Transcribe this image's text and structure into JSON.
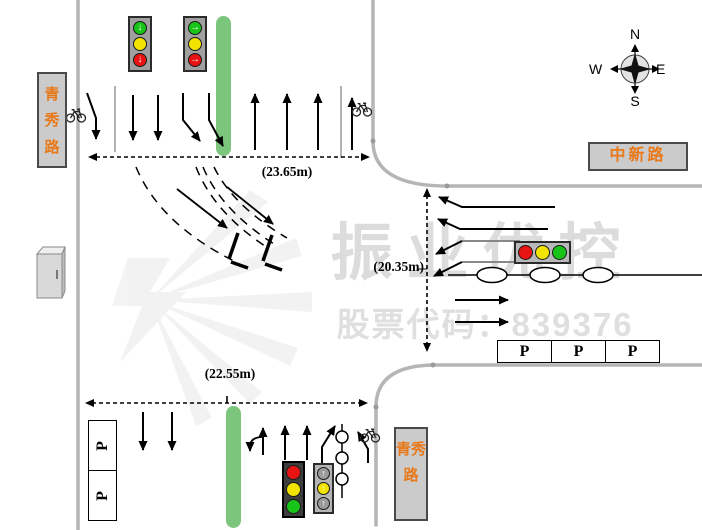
{
  "road_labels": {
    "north": "青秀路",
    "east": "中新路",
    "south": "青秀路"
  },
  "dimensions": {
    "north_width": "(23.65m)",
    "east_width": "(20.35m)",
    "south_width": "(22.55m)"
  },
  "compass": {
    "n": "N",
    "e": "E",
    "s": "S",
    "w": "W"
  },
  "parking": {
    "symbol": "P",
    "east_row_cells": 3,
    "south_column_cells": 2
  },
  "watermark": {
    "company": "振业优控",
    "stock_line": "股票代码：839376"
  },
  "traffic_lights": {
    "north_left": {
      "lamps": [
        {
          "color": "green",
          "glyph": "↓"
        },
        {
          "color": "yellow",
          "glyph": ""
        },
        {
          "color": "red",
          "glyph": "↓"
        }
      ]
    },
    "north_right": {
      "lamps": [
        {
          "color": "green",
          "glyph": "→"
        },
        {
          "color": "yellow",
          "glyph": ""
        },
        {
          "color": "red",
          "glyph": "→"
        }
      ]
    },
    "east": {
      "lamps": [
        {
          "color": "red",
          "glyph": ""
        },
        {
          "color": "yellow",
          "glyph": ""
        },
        {
          "color": "green",
          "glyph": ""
        }
      ]
    },
    "south_left": {
      "lamps": [
        {
          "color": "red",
          "glyph": ""
        },
        {
          "color": "yellow",
          "glyph": ""
        },
        {
          "color": "green",
          "glyph": ""
        }
      ]
    },
    "south_right": {
      "lamps": [
        {
          "color": "gray",
          "glyph": "↑"
        },
        {
          "color": "yellow",
          "glyph": "↑"
        },
        {
          "color": "gray",
          "glyph": "↑"
        }
      ]
    }
  },
  "colors": {
    "road_edge": "#B5B5B5",
    "median_green": "#7CC57C",
    "label_text_orange": "#E87818",
    "label_box_gray": "#CBCBCB",
    "signal_red": "#E81313",
    "signal_yellow": "#F2E400",
    "signal_green": "#17C417"
  }
}
